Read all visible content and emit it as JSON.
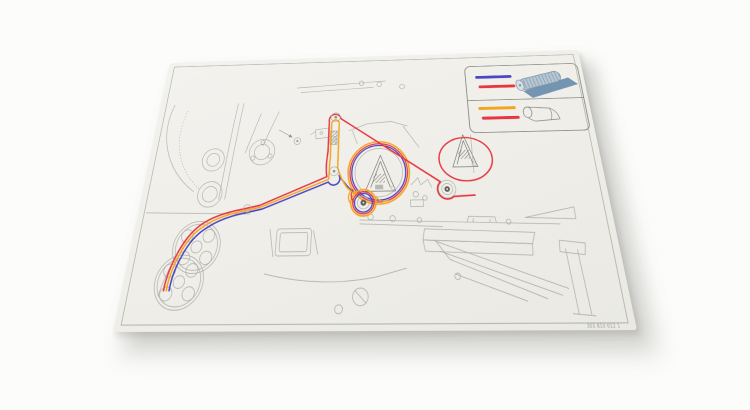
{
  "scene": {
    "background": "#fcfcfb",
    "sheet_color": "#f0efe9",
    "description": "machine-threading-diagram-decal"
  },
  "colors": {
    "blue": "#4a46c4",
    "orange": "#f4a51f",
    "red": "#e8353f",
    "line": "#adaea7",
    "line-dark": "#70716a",
    "border": "#b4b5ae",
    "roll-fill": "#b7c6d2",
    "roll-sheet": "#6b8fae",
    "roll-edge": "#7a8da0"
  },
  "legend": {
    "rows": [
      {
        "icon": "net-roll-icon",
        "line_colors": [
          "blue",
          "red"
        ]
      },
      {
        "icon": "film-roll-icon",
        "line_colors": [
          "orange",
          "red"
        ]
      }
    ]
  },
  "footer": {
    "part_number": "303 810 012 1"
  }
}
